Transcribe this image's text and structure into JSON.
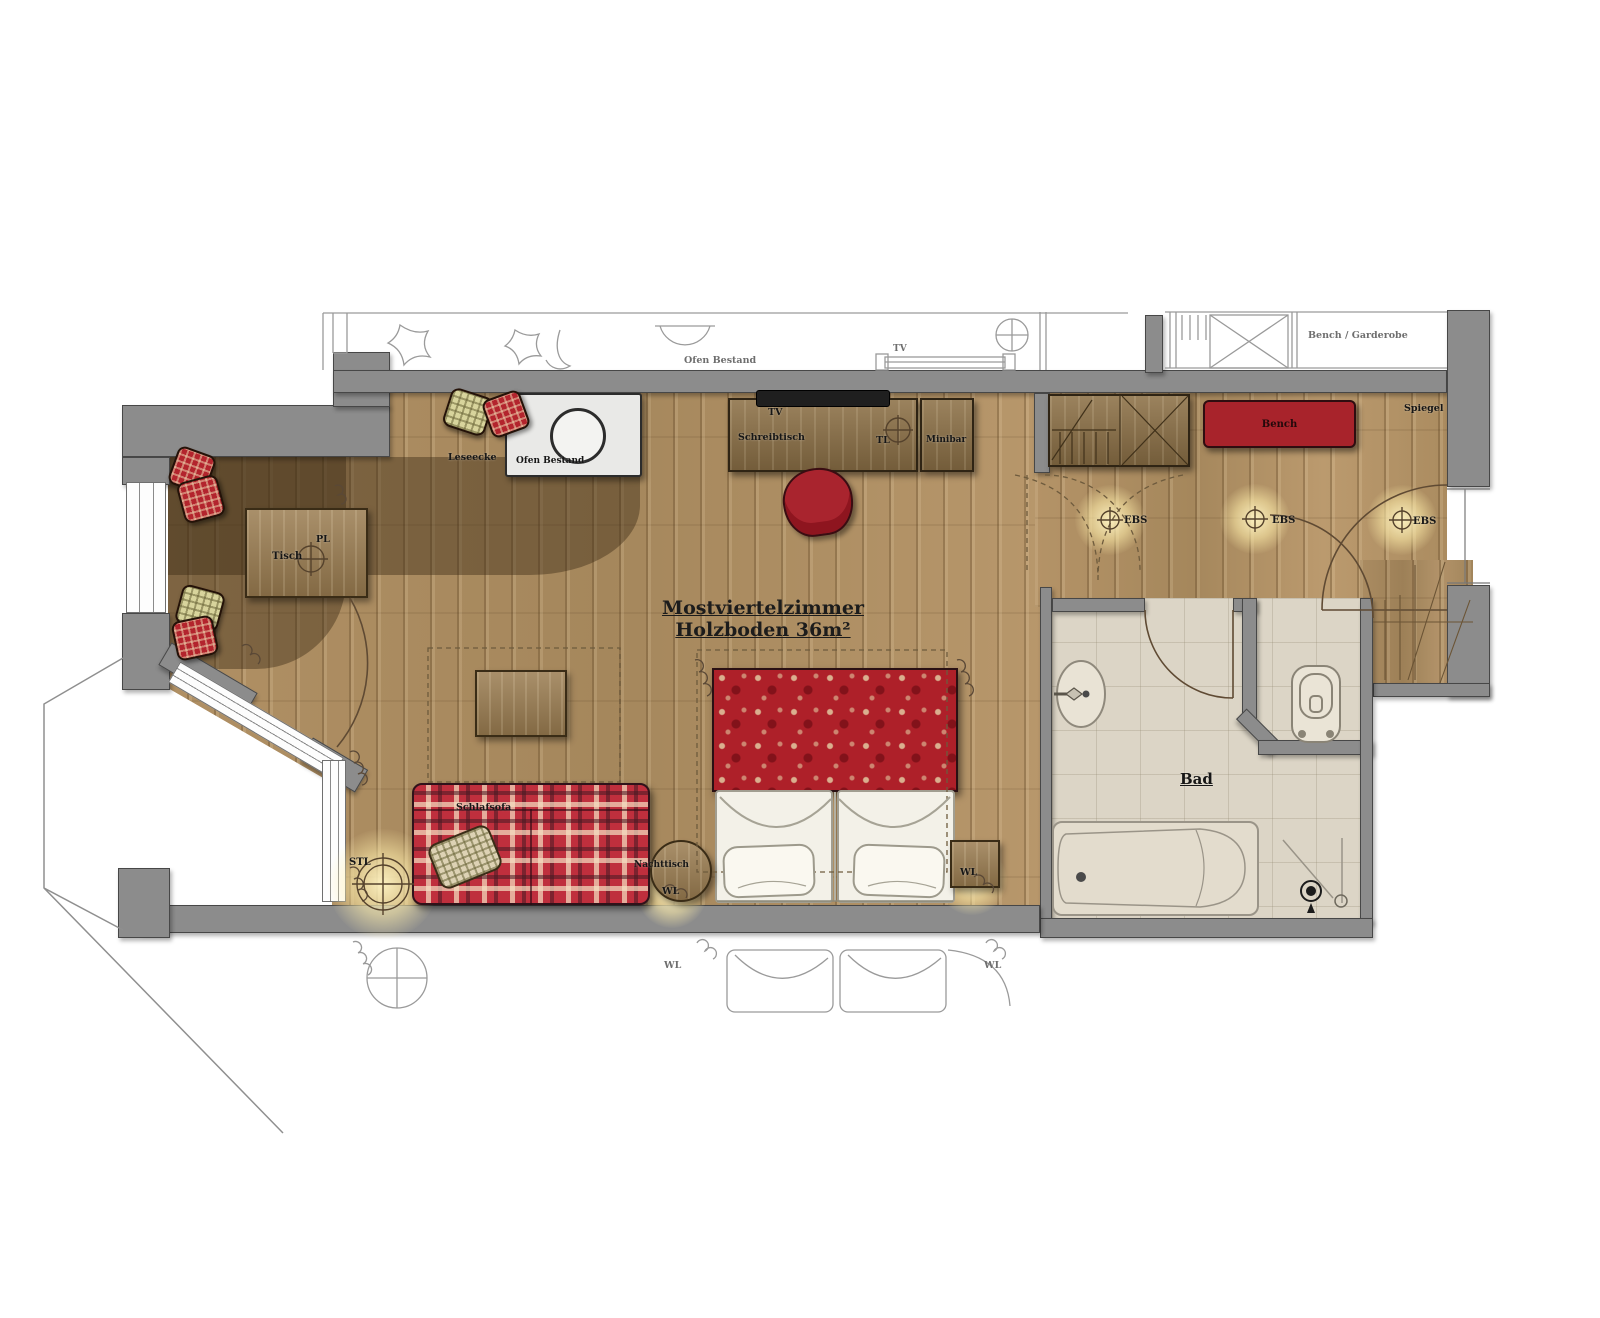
{
  "plan": {
    "title": {
      "line1": "Mostviertelzimmer",
      "line2": "Holzboden 36m²"
    },
    "rooms": {
      "main_room": "Mostviertelzimmer",
      "bathroom": "Bad"
    },
    "labels": {
      "leseecke": "Leseecke",
      "ofen_bestand": "Ofen Bestand",
      "tv": "TV",
      "schreibtisch": "Schreibtisch",
      "tl": "TL",
      "minibar": "Minibar",
      "bench": "Bench",
      "bench_garderobe": "Bench / Garderobe",
      "spiegel": "Spiegel",
      "ebs": "EBS",
      "tisch": "Tisch",
      "pl": "PL",
      "stl": "STL",
      "schlafsofa": "Schlafsofa",
      "nachttisch": "Nachttisch",
      "wl": "WL",
      "bad": "Bad"
    },
    "colors": {
      "wall_gray": "#8c8c8c",
      "wood_floor": "#b09065",
      "leseecke_dark_overlay": "rgba(58,40,18,0.42)",
      "bath_tile": "#dcd5c6",
      "accent_red": "#a8232b",
      "furniture_wood": "#8d7147",
      "plaid_red": "#bf2f3d",
      "floral_red": "#ae2029",
      "light_glow": "#ffeeb0",
      "sketch_line": "#9a9a9a",
      "label_text": "#161616"
    }
  }
}
